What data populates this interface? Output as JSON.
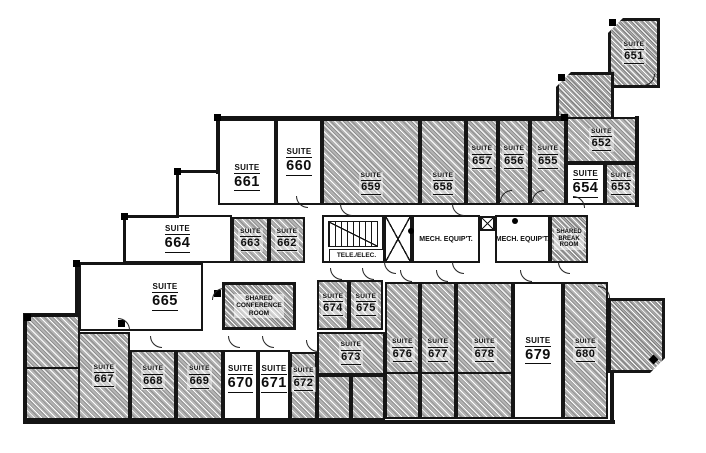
{
  "colors": {
    "wall": "#141414",
    "hatch_fill": "#b3b3b3",
    "open_room": "#ffffff"
  },
  "suites": {
    "s651": {
      "type": "SUITE",
      "num": "651",
      "shaded": true
    },
    "s652": {
      "type": "SUITE",
      "num": "652",
      "shaded": true
    },
    "s653": {
      "type": "SUITE",
      "num": "653",
      "shaded": true
    },
    "s654": {
      "type": "SUITE",
      "num": "654",
      "shaded": false
    },
    "s655": {
      "type": "SUITE",
      "num": "655",
      "shaded": true
    },
    "s656": {
      "type": "SUITE",
      "num": "656",
      "shaded": true
    },
    "s657": {
      "type": "SUITE",
      "num": "657",
      "shaded": true
    },
    "s658": {
      "type": "SUITE",
      "num": "658",
      "shaded": true
    },
    "s659": {
      "type": "SUITE",
      "num": "659",
      "shaded": true
    },
    "s660": {
      "type": "SUITE",
      "num": "660",
      "shaded": false
    },
    "s661": {
      "type": "SUITE",
      "num": "661",
      "shaded": false
    },
    "s662": {
      "type": "SUITE",
      "num": "662",
      "shaded": true
    },
    "s663": {
      "type": "SUITE",
      "num": "663",
      "shaded": true
    },
    "s664": {
      "type": "SUITE",
      "num": "664",
      "shaded": false
    },
    "s665": {
      "type": "SUITE",
      "num": "665",
      "shaded": false
    },
    "s667": {
      "type": "SUITE",
      "num": "667",
      "shaded": true
    },
    "s668": {
      "type": "SUITE",
      "num": "668",
      "shaded": true
    },
    "s669": {
      "type": "SUITE",
      "num": "669",
      "shaded": true
    },
    "s670": {
      "type": "SUITE",
      "num": "670",
      "shaded": false
    },
    "s671": {
      "type": "SUITE",
      "num": "671",
      "shaded": false
    },
    "s672": {
      "type": "SUITE",
      "num": "672",
      "shaded": true
    },
    "s673": {
      "type": "SUITE",
      "num": "673",
      "shaded": true
    },
    "s674": {
      "type": "SUITE",
      "num": "674",
      "shaded": true
    },
    "s675": {
      "type": "SUITE",
      "num": "675",
      "shaded": true
    },
    "s676": {
      "type": "SUITE",
      "num": "676",
      "shaded": true
    },
    "s677": {
      "type": "SUITE",
      "num": "677",
      "shaded": true
    },
    "s678": {
      "type": "SUITE",
      "num": "678",
      "shaded": true
    },
    "s679": {
      "type": "SUITE",
      "num": "679",
      "shaded": false
    },
    "s680": {
      "type": "SUITE",
      "num": "680",
      "shaded": true
    }
  },
  "service_rooms": {
    "tele_elec": "TELE./ELEC.",
    "mech_1": "MECH. EQUIP'T.",
    "mech_2": "MECH. EQUIP'T.",
    "shared_break": [
      "SHARED",
      "BREAK",
      "ROOM"
    ],
    "shared_conference": [
      "SHARED",
      "CONFERENCE",
      "ROOM"
    ]
  }
}
